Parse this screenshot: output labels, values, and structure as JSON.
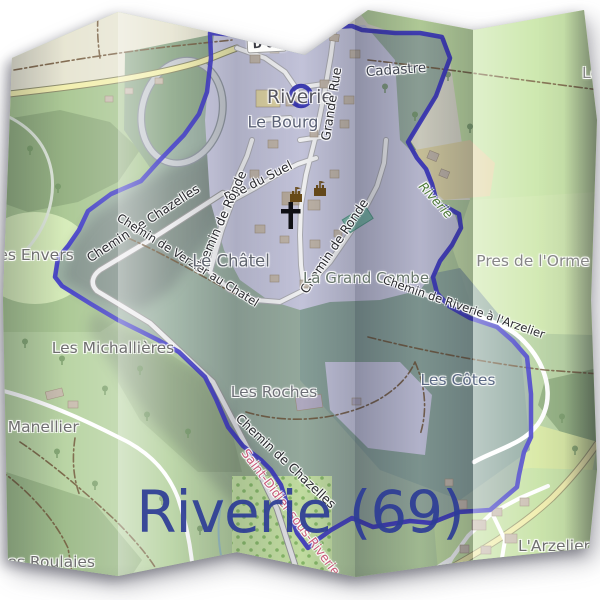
{
  "map": {
    "commune": "Riverie",
    "department_code": "69",
    "style": "openstreetmap-carto folded paper poster"
  },
  "title": {
    "text": "Riverie (69)",
    "color": "#2d3c96"
  },
  "labels": {
    "d63": {
      "text": "D 63"
    },
    "riverie_place": {
      "text": "Riverie"
    },
    "le_bourg": {
      "text": "Le Bourg"
    },
    "cadastre": {
      "text": "Cadastre"
    },
    "grande_rue": {
      "text": "Grande Rue"
    },
    "rue_du_suel": {
      "text": "Rue du Suel"
    },
    "chemin_ronde_w": {
      "text": "Chemin de Ronde"
    },
    "chemin_ronde_e": {
      "text": "Chemin de Ronde"
    },
    "chemin_chazelles_nw": {
      "text": "Chemin de Chazelles"
    },
    "chemin_chazelles_s": {
      "text": "Chemin de Chazelles"
    },
    "chemin_verzier": {
      "text": "Chemin de Verzier au Chatel"
    },
    "chemin_riverie_arzelier": {
      "text": "Chemin de Riverie à l'Arzelier"
    },
    "le_chatel": {
      "text": "Le Châtel"
    },
    "la_grand_combe": {
      "text": "La Grand Combe"
    },
    "pres_de_lorme": {
      "text": "Pres de l'Orme"
    },
    "riverie_stream": {
      "text": "Riverie"
    },
    "les_envers": {
      "text": "es Envers"
    },
    "les_michallieres": {
      "text": "Les Michallières"
    },
    "le_manellier": {
      "text": "e Manellier"
    },
    "les_roches": {
      "text": "Les Roches"
    },
    "les_cotes": {
      "text": "Les Côtes"
    },
    "saint_didier": {
      "text": "Saint-Didier-sous-Riverie"
    },
    "larzelier": {
      "text": "L'Arzelier"
    },
    "les_roulaies": {
      "text": "Les Roulaies"
    },
    "le_partial": {
      "text": "Le"
    },
    "title": {
      "text": "Riverie (69)"
    }
  },
  "icons": {
    "castle_icon_count": 2,
    "church_cross_icon_count": 1,
    "place_ring_icon_count": 1
  },
  "colors": {
    "boundary_blue": "#3c35c8",
    "title_navy": "#2d3c96",
    "meadow_green": "#b7d3a1",
    "forest_green": "#8cab7b",
    "village_lavender": "#cfcfe6",
    "road_yellow": "#f2efad",
    "road_white": "#ffffff",
    "pitch_teal": "#7fbfae",
    "neighbor_commune_pink": "#c75274",
    "label_halo": "#ffffff"
  }
}
